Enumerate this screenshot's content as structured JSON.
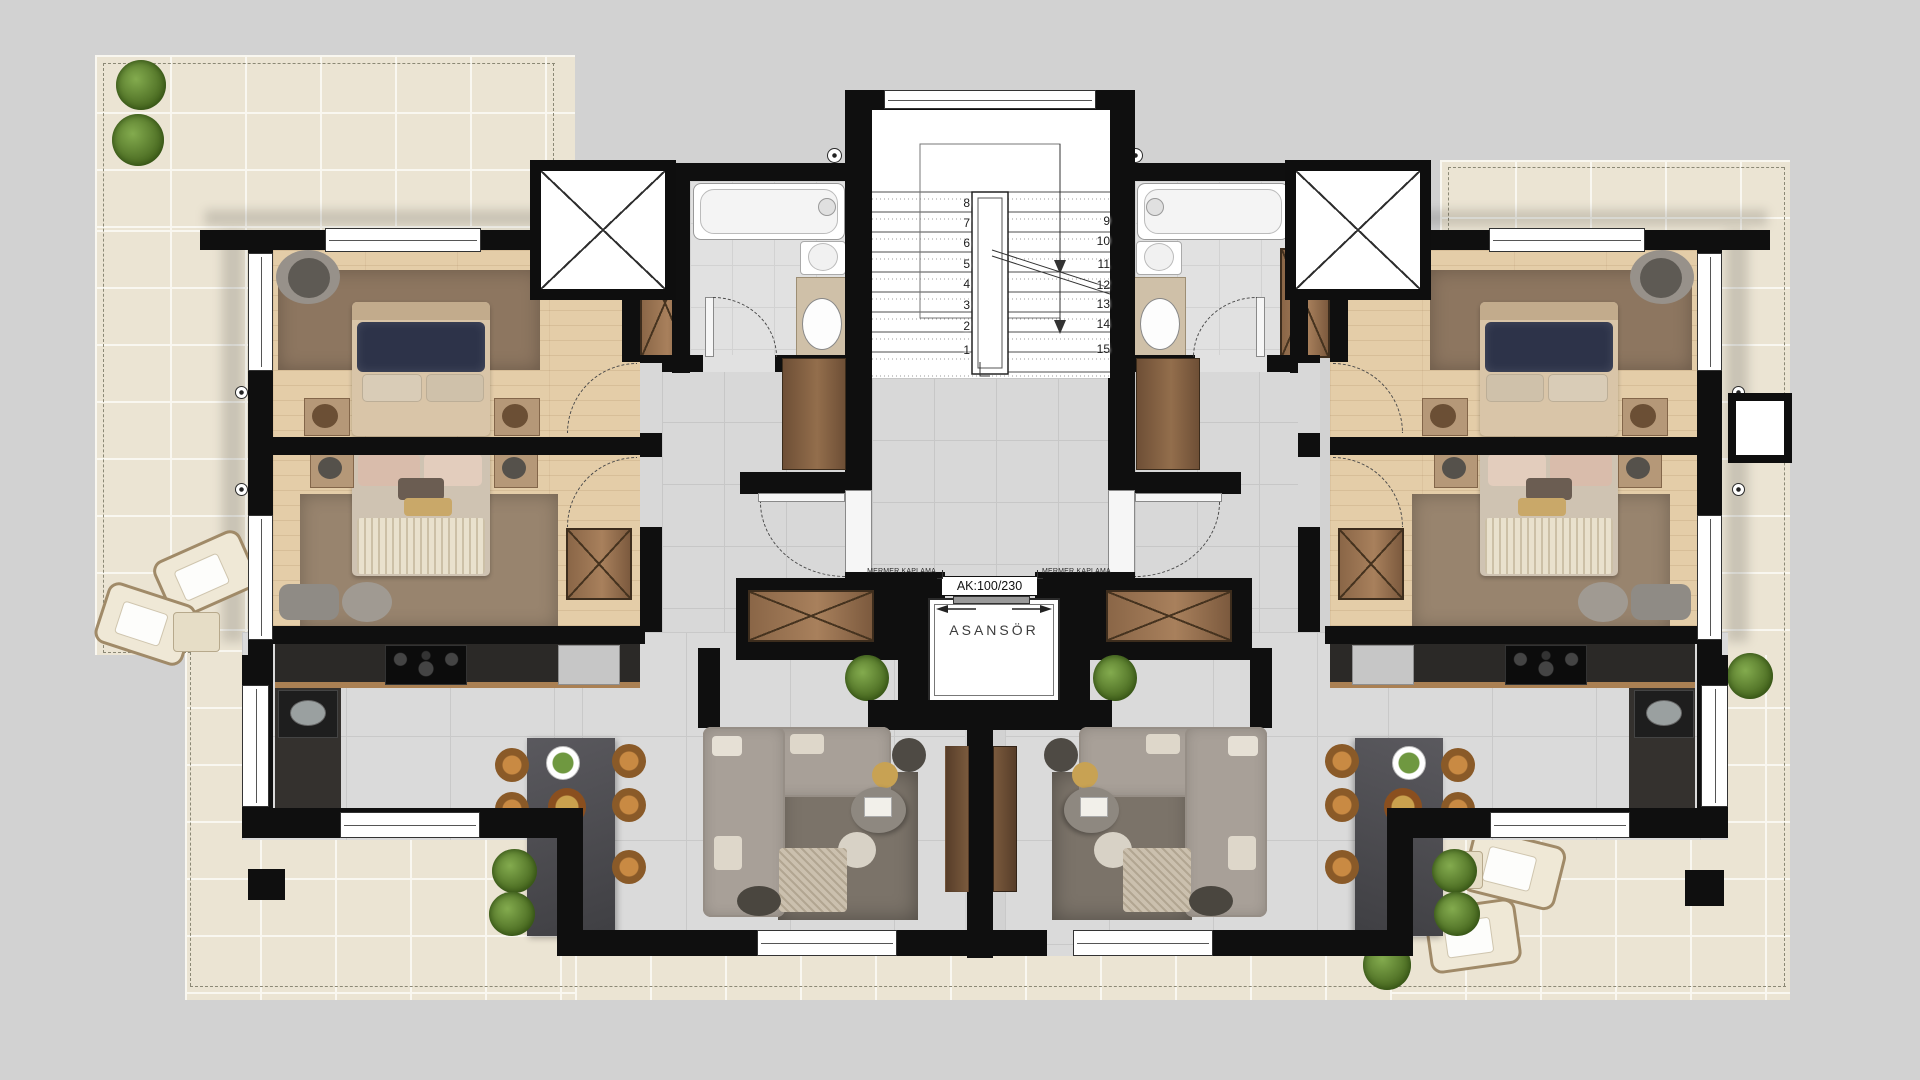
{
  "plan": {
    "stairwell": {
      "numbers_left": [
        "8",
        "7",
        "6",
        "5",
        "4",
        "3",
        "2",
        "1"
      ],
      "numbers_right": [
        "9",
        "10",
        "11",
        "12",
        "13",
        "14",
        "15"
      ]
    },
    "elevator": {
      "label": "ASANSÖR",
      "shaft_size_label": "AK:100/230"
    },
    "annotations": {
      "marble_cladding_left": "MERMER KAPLAMA",
      "marble_cladding_right": "MERMER KAPLAMA"
    },
    "colors": {
      "background": "#d2d2d2",
      "wall": "#0f0f0f",
      "terrace_tile": "#ebe4d3",
      "interior_tile": "#dadada",
      "wood_floor": "#e4cda8",
      "kitchen_counter": "#2b2927",
      "cabinet_wood": "#8a6647",
      "sofa": "#a8a098",
      "rug": "#8d7660",
      "bed_blanket_navy": "#2d3349",
      "plant": "#5a8038",
      "dining_chair": "#b97e3c"
    }
  }
}
